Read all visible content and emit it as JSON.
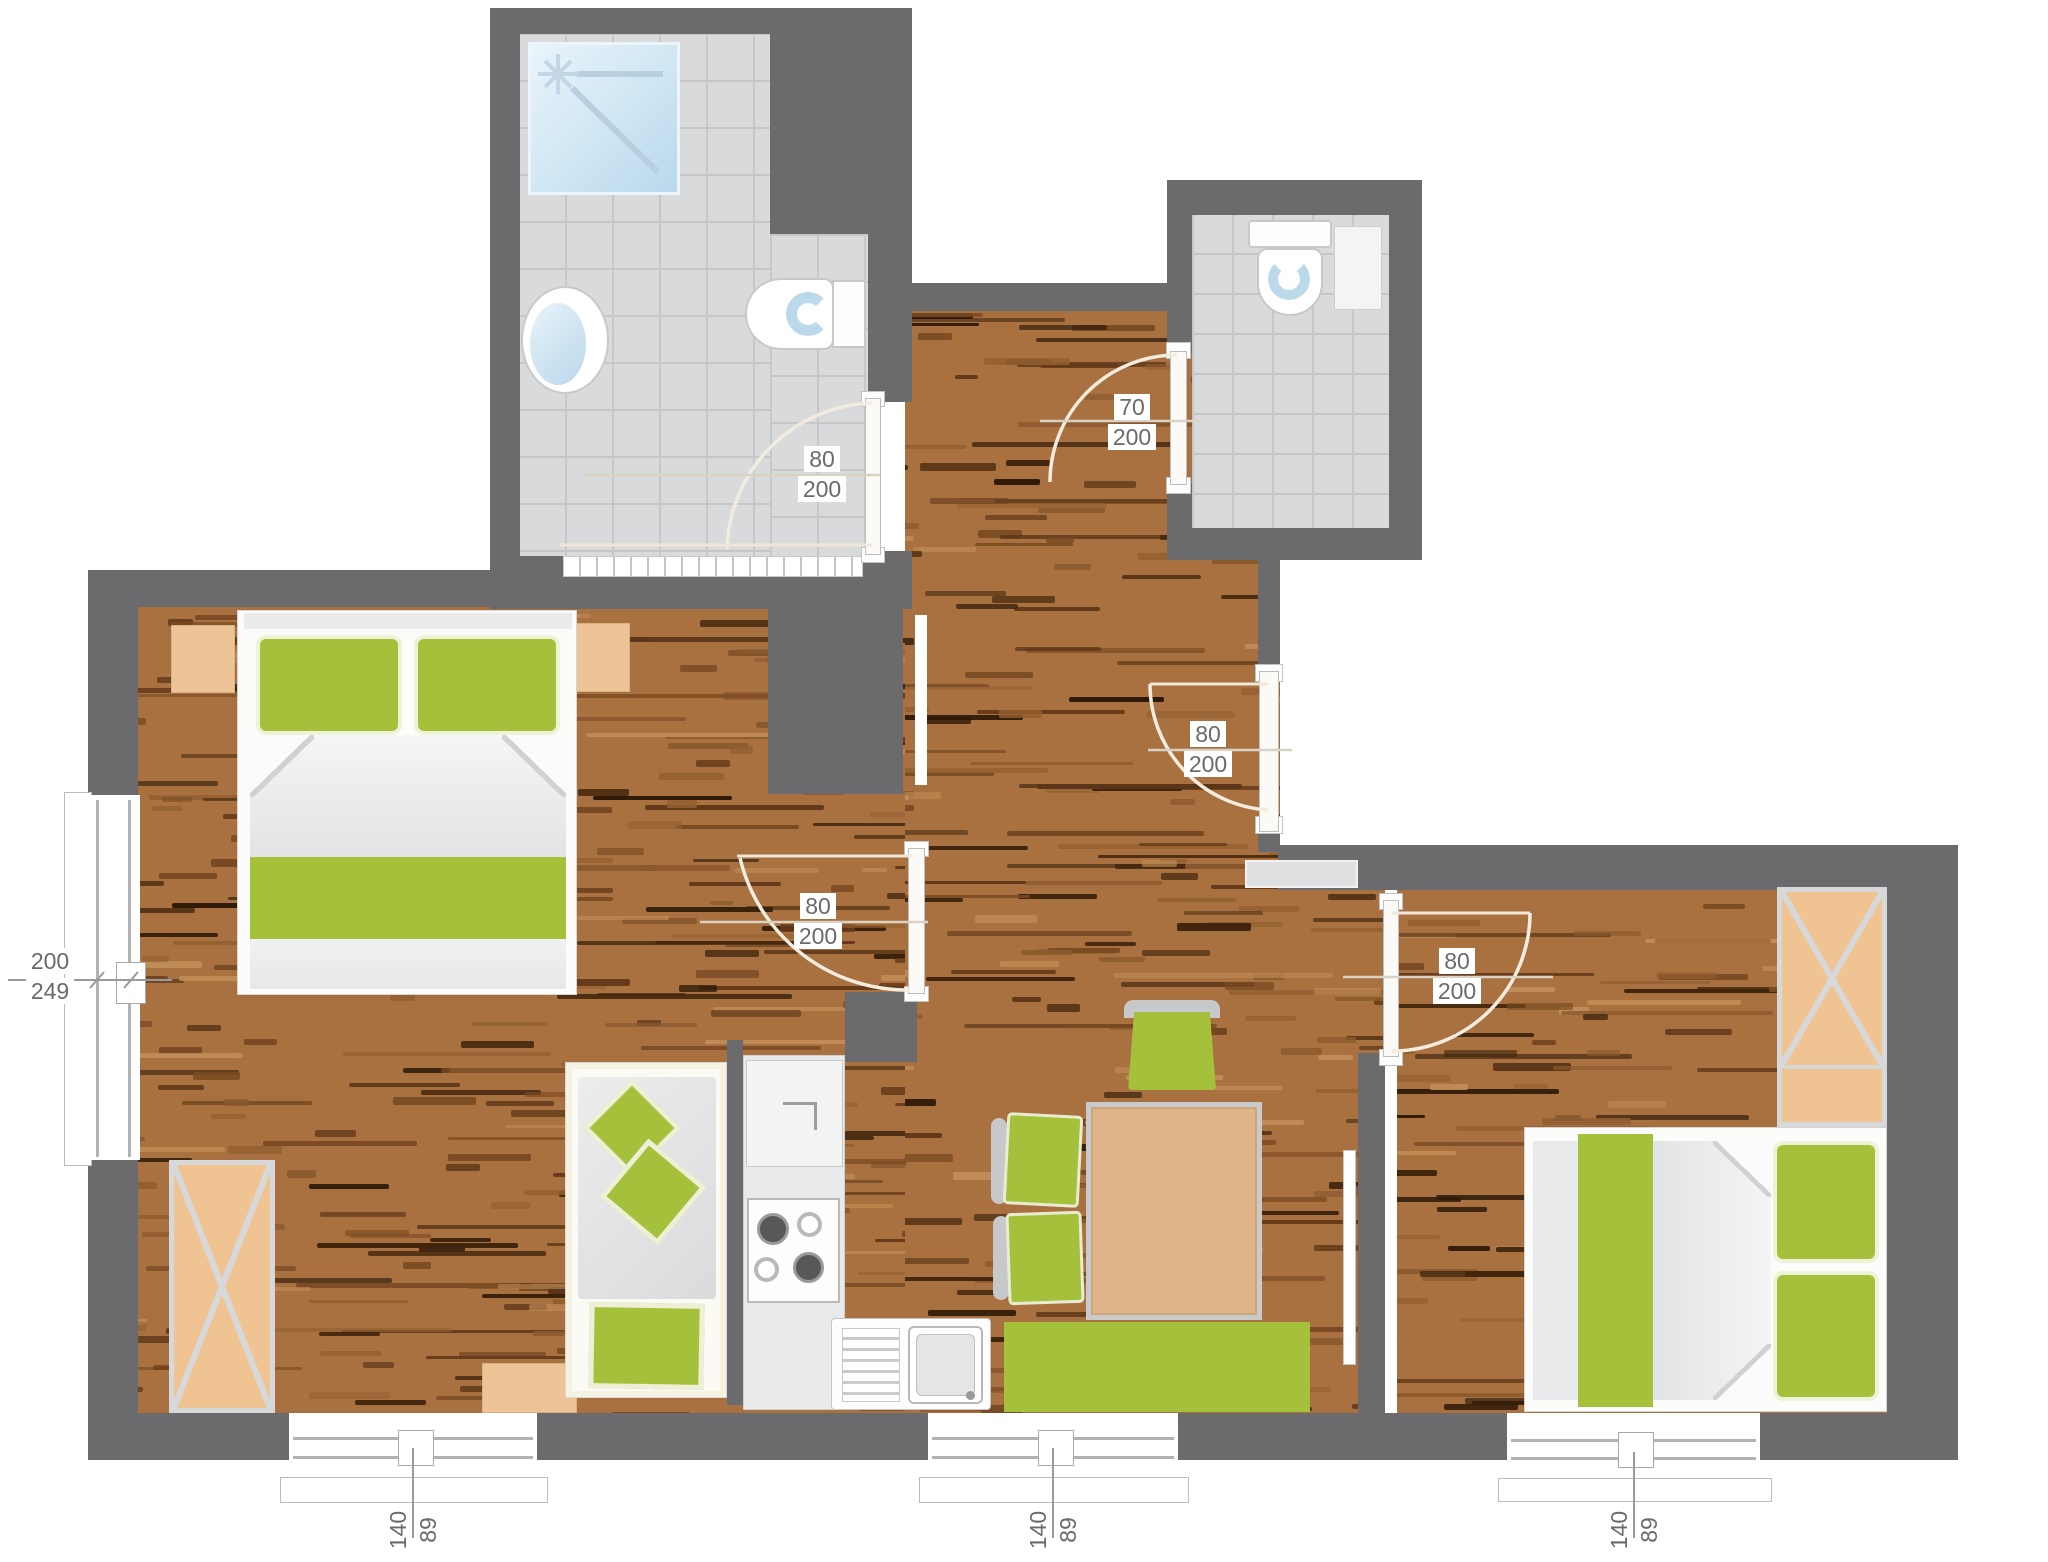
{
  "labels": {
    "door_bathroom": {
      "w": "80",
      "h": "200"
    },
    "door_wc": {
      "w": "70",
      "h": "200"
    },
    "door_bedroom_left": {
      "w": "80",
      "h": "200"
    },
    "door_entry_hall": {
      "w": "80",
      "h": "200"
    },
    "door_bedroom_right": {
      "w": "80",
      "h": "200"
    },
    "window_left": {
      "w": "200",
      "h": "249"
    },
    "window_bottom_left": {
      "w": "140",
      "h": "89"
    },
    "window_bottom_center": {
      "w": "140",
      "h": "89"
    },
    "window_bottom_right": {
      "w": "140",
      "h": "89"
    }
  },
  "colors": {
    "wall": "#6b6b6d",
    "wood_base": "#a9713f",
    "wood_streaks": [
      "#5a3517",
      "#7a4a22",
      "#40240c",
      "#8a5a2e",
      "#c08c57",
      "#65391a",
      "#2e1a08",
      "#935f30"
    ],
    "tile": "#d8dadb",
    "grout": "#c5c7c9",
    "green": "#a5c13c",
    "tan": "#eec497",
    "counter": "#e9eaeb",
    "fixture_blue": "#c7dff0",
    "swing_arc": "#f2ecdf",
    "dimension_line": "#9a9a9a",
    "label_text": "#6a6a6a"
  }
}
